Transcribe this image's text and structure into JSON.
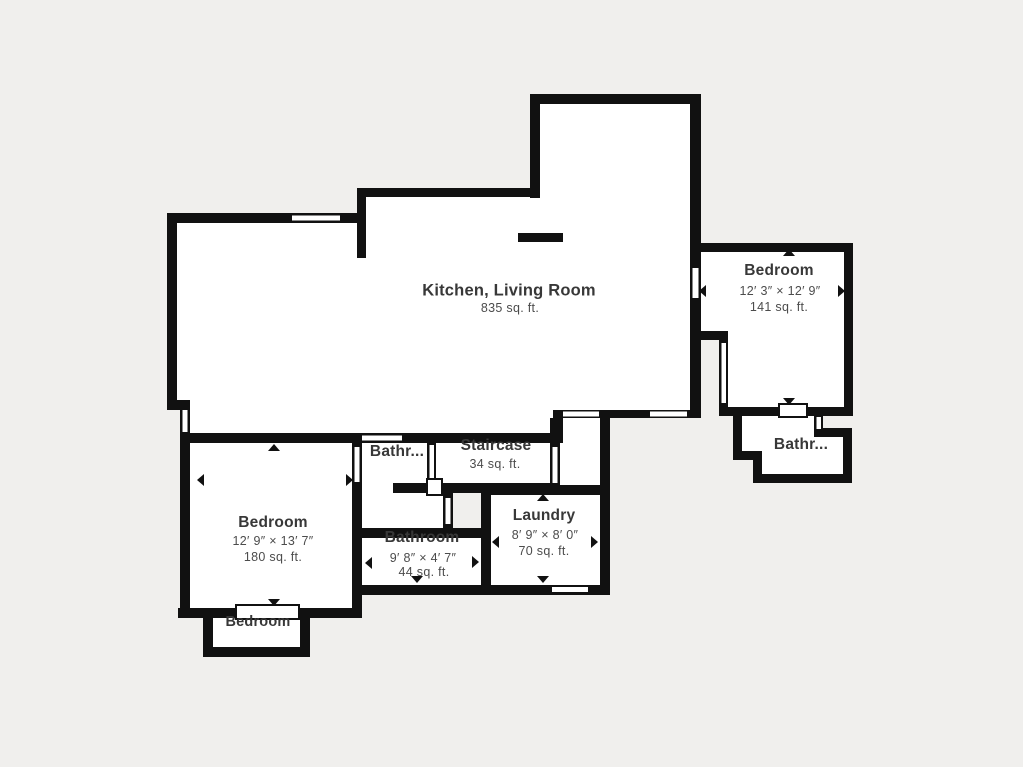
{
  "canvas": {
    "background": "#f0efed",
    "wall_color": "#111111",
    "room_fill": "#ffffff",
    "name_text_color": "#383838",
    "detail_text_color": "#4c4c4c"
  },
  "rooms": [
    {
      "id": "kitchen-living",
      "name": "Kitchen, Living Room",
      "area": "835 sq. ft."
    },
    {
      "id": "bedroom-right",
      "name": "Bedroom",
      "dims": "12′ 3″ × 12′ 9″",
      "area": "141 sq. ft."
    },
    {
      "id": "bathroom-right",
      "name": "Bathr..."
    },
    {
      "id": "staircase",
      "name": "Staircase",
      "area": "34 sq. ft."
    },
    {
      "id": "bathroom-hall",
      "name": "Bathr..."
    },
    {
      "id": "laundry",
      "name": "Laundry",
      "dims": "8′ 9″ × 8′ 0″",
      "area": "70 sq. ft."
    },
    {
      "id": "bedroom-left",
      "name": "Bedroom",
      "dims": "12′ 9″ × 13′ 7″",
      "area": "180 sq. ft."
    },
    {
      "id": "bathroom-middle",
      "name": "Bathroom",
      "dims": "9′ 8″ × 4′ 7″",
      "area": "44 sq. ft."
    },
    {
      "id": "bedroom-nook",
      "name": "Bedroom"
    }
  ]
}
